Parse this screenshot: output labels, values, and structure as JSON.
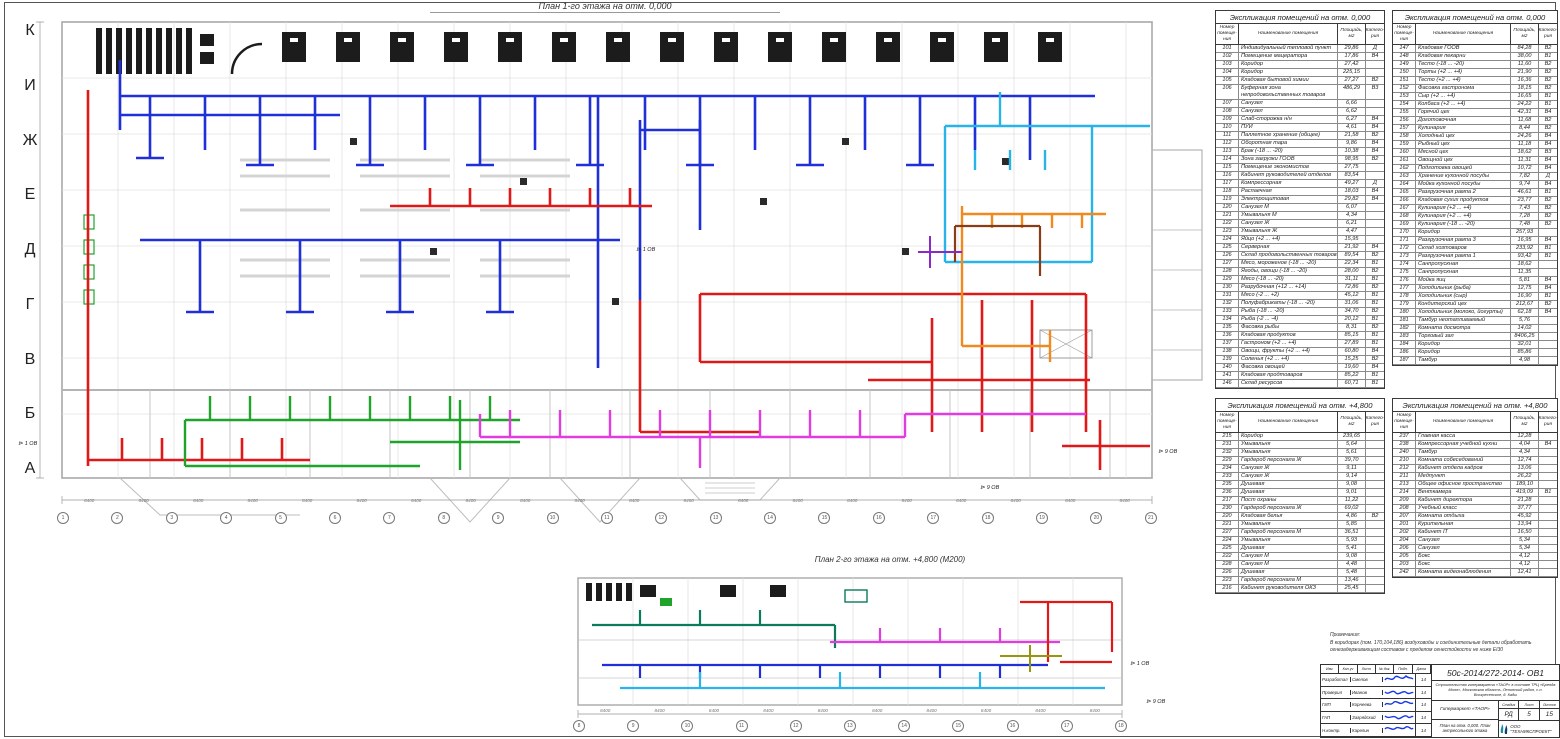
{
  "plan1": {
    "title": "План 1-го этажа на отм. 0,000",
    "axis_bottom": [
      "1",
      "2",
      "3",
      "4",
      "5",
      "6",
      "7",
      "8",
      "9",
      "10",
      "11",
      "12",
      "13",
      "14",
      "15",
      "16",
      "17",
      "18",
      "19",
      "20",
      "21"
    ],
    "axis_left": [
      "К",
      "И",
      "Ж",
      "Е",
      "Д",
      "Г",
      "В",
      "Б",
      "А"
    ],
    "dims_bottom": [
      "8400",
      "8400",
      "8400",
      "8400",
      "8400",
      "8400",
      "8400",
      "8400",
      "8400",
      "8400",
      "8400",
      "8400",
      "8400",
      "8400",
      "8400",
      "8400",
      "8400",
      "8400",
      "8400",
      "8400"
    ]
  },
  "plan2": {
    "title": "План 2-го этажа на отм. +4,800 (М200)",
    "axis_bottom": [
      "8",
      "9",
      "10",
      "11",
      "12",
      "13",
      "14",
      "15",
      "16",
      "17",
      "18"
    ],
    "dims_bottom": [
      "8400",
      "8400",
      "8400",
      "8400",
      "8400",
      "8400",
      "8400",
      "8400",
      "8400",
      "8400"
    ]
  },
  "flags": {
    "labels": [
      "1 ОВ",
      "1 ОВ",
      "9 ОВ",
      "9 ОВ",
      "1 ОВ",
      "9 ОВ"
    ]
  },
  "colors": {
    "duct_supply_blue": "#2030d8",
    "duct_return_red": "#e01818",
    "duct_cyan": "#28b4e8",
    "duct_green": "#1fa32a",
    "duct_magenta": "#e03ce0",
    "duct_orange": "#f08a1e",
    "duct_brown": "#8a3c14",
    "duct_teal": "#0c7a5c",
    "duct_olive": "#96960f",
    "duct_purple": "#8a28c8",
    "equipment_black": "#1c1c1c",
    "walls_gray": "#b0b0b0",
    "signature_blue": "#1538e8"
  },
  "tables": [
    {
      "title": "Экспликация помещений на отм. 0,000",
      "col_num": "Номер помеще- ния",
      "col_name": "Наименование помещения",
      "col_area": "Площадь, м2",
      "col_cat": "Катего- рия",
      "rows": [
        [
          "101",
          "Индивидуальный тепловой пункт",
          "29,86",
          "Д"
        ],
        [
          "102",
          "Помещение мацератора",
          "17,86",
          "В4"
        ],
        [
          "103",
          "Коридор",
          "27,42",
          ""
        ],
        [
          "104",
          "Коридор",
          "225,15",
          ""
        ],
        [
          "105",
          "Кладовая бытовой химии",
          "27,27",
          "В2"
        ],
        [
          "106",
          "Буферная зона непродовольственных товаров",
          "486,29",
          "В3"
        ],
        [
          "107",
          "Санузел",
          "6,66",
          ""
        ],
        [
          "108",
          "Санузел",
          "6,62",
          ""
        ],
        [
          "109",
          "Слаб-сторожка н/н",
          "6,27",
          "В4"
        ],
        [
          "110",
          "ПУИ",
          "4,61",
          "В4"
        ],
        [
          "111",
          "Паллетное хранение (общее)",
          "21,58",
          "В2"
        ],
        [
          "112",
          "Оборотная тара",
          "9,86",
          "В4"
        ],
        [
          "113",
          "Брак (-18 ... -20)",
          "10,38",
          "В4"
        ],
        [
          "114",
          "Зона загрузки ГООВ",
          "98,95",
          "В2"
        ],
        [
          "115",
          "Помещение экономистов",
          "27,75",
          ""
        ],
        [
          "116",
          "Кабинет руководителей отделов",
          "83,54",
          ""
        ],
        [
          "117",
          "Компрессорная",
          "49,27",
          "Д"
        ],
        [
          "118",
          "Распаечная",
          "18,03",
          "В4"
        ],
        [
          "119",
          "Электрощитовая",
          "29,82",
          "В4"
        ],
        [
          "120",
          "Санузел М",
          "6,07",
          ""
        ],
        [
          "121",
          "Умывальня М",
          "4,34",
          ""
        ],
        [
          "122",
          "Санузел Ж",
          "6,21",
          ""
        ],
        [
          "123",
          "Умывальня Ж",
          "4,47",
          ""
        ],
        [
          "124",
          "Яйцо (+2 ... +4)",
          "15,95",
          ""
        ],
        [
          "125",
          "Серверная",
          "21,92",
          "В4"
        ],
        [
          "126",
          "Склад продовольственных товаров",
          "89,54",
          "В2"
        ],
        [
          "127",
          "Мясо, мороженое (-18 ... -20)",
          "22,34",
          "В1"
        ],
        [
          "128",
          "Ягоды, овощи (-18 ... -20)",
          "28,00",
          "В2"
        ],
        [
          "129",
          "Мясо (-18 ... -20)",
          "31,11",
          "В1"
        ],
        [
          "130",
          "Разрубочная (+12 ... +14)",
          "72,86",
          "В2"
        ],
        [
          "131",
          "Мясо (-2 ... +2)",
          "45,12",
          "В1"
        ],
        [
          "132",
          "Полуфабрикаты (-18 ... -20)",
          "31,06",
          "В1"
        ],
        [
          "133",
          "Рыба (-18 ... -20)",
          "34,70",
          "В2"
        ],
        [
          "134",
          "Рыба (-2 ... -4)",
          "20,12",
          "В1"
        ],
        [
          "135",
          "Фасовка рыбы",
          "8,31",
          "В2"
        ],
        [
          "136",
          "Кладовая продуктов",
          "85,15",
          "В1"
        ],
        [
          "137",
          "Гастроном (+2 ... +4)",
          "27,89",
          "В1"
        ],
        [
          "138",
          "Овощи, фрукты (+2 ... +4)",
          "60,80",
          "В4"
        ],
        [
          "139",
          "Соленья (+2 ... +4)",
          "15,25",
          "В2"
        ],
        [
          "140",
          "Фасовка овощей",
          "19,60",
          "В4"
        ],
        [
          "141",
          "Кладовая продтоваров",
          "85,22",
          "В1"
        ],
        [
          "146",
          "Склад ресурсов",
          "60,71",
          "В1"
        ]
      ]
    },
    {
      "title": "Экспликация помещений на отм. 0,000",
      "col_num": "Номер помеще- ния",
      "col_name": "Наименование помещения",
      "col_area": "Площадь, м2",
      "col_cat": "Катего- рия",
      "rows": [
        [
          "147",
          "Кладовая ГООВ",
          "84,28",
          "В2"
        ],
        [
          "148",
          "Кладовая пекарни",
          "38,00",
          "В1"
        ],
        [
          "149",
          "Тесто (-18 ... -20)",
          "11,60",
          "В2"
        ],
        [
          "150",
          "Торты (+2 ... +4)",
          "21,90",
          "В2"
        ],
        [
          "151",
          "Тесто (+2 ... +4)",
          "16,36",
          "В2"
        ],
        [
          "152",
          "Фасовка гастронома",
          "18,15",
          "В2"
        ],
        [
          "153",
          "Сыр (+2 ... +4)",
          "16,65",
          "В1"
        ],
        [
          "154",
          "Колбаса (+2 ... +4)",
          "24,22",
          "В1"
        ],
        [
          "155",
          "Горячий цех",
          "42,31",
          "В4"
        ],
        [
          "156",
          "Доготовочная",
          "11,68",
          "В2"
        ],
        [
          "157",
          "Кулинария",
          "8,44",
          "В2"
        ],
        [
          "158",
          "Холодный цех",
          "24,26",
          "В4"
        ],
        [
          "159",
          "Рыбный цех",
          "11,18",
          "В4"
        ],
        [
          "160",
          "Мясной цех",
          "18,62",
          "В3"
        ],
        [
          "161",
          "Овощной цех",
          "11,31",
          "В4"
        ],
        [
          "162",
          "Подготовка овощей",
          "10,72",
          "В4"
        ],
        [
          "163",
          "Хранение кухонной посуды",
          "7,82",
          "Д"
        ],
        [
          "164",
          "Мойка кухонной посуды",
          "9,74",
          "В4"
        ],
        [
          "165",
          "Разгрузочная рампа 2",
          "46,61",
          "В1"
        ],
        [
          "166",
          "Кладовая сухих продуктов",
          "23,77",
          "В2"
        ],
        [
          "167",
          "Кулинария (+2 ... +4)",
          "7,43",
          "В2"
        ],
        [
          "168",
          "Кулинария (+2 ... +4)",
          "7,28",
          "В2"
        ],
        [
          "169",
          "Кулинария (-18 ... -20)",
          "7,48",
          "В2"
        ],
        [
          "170",
          "Коридор",
          "257,93",
          ""
        ],
        [
          "171",
          "Разгрузочная рампа 3",
          "16,95",
          "В4"
        ],
        [
          "172",
          "Склад хозтоваров",
          "233,92",
          "В1"
        ],
        [
          "173",
          "Разгрузочная рампа 1",
          "93,42",
          "В1"
        ],
        [
          "174",
          "Санпропускная",
          "18,62",
          ""
        ],
        [
          "175",
          "Санпропускная",
          "11,35",
          ""
        ],
        [
          "176",
          "Мойка яиц",
          "5,81",
          "В4"
        ],
        [
          "177",
          "Холодильник (рыба)",
          "12,75",
          "В4"
        ],
        [
          "178",
          "Холодильник (сыр)",
          "16,90",
          "В1"
        ],
        [
          "179",
          "Кондитерский цех",
          "212,67",
          "В2"
        ],
        [
          "180",
          "Холодильник (молоко, йогурты)",
          "62,18",
          "В4"
        ],
        [
          "181",
          "Тамбур неотапливаемый",
          "5,76",
          ""
        ],
        [
          "182",
          "Комната досмотра",
          "14,02",
          ""
        ],
        [
          "183",
          "Торговый зал",
          "8406,25",
          ""
        ],
        [
          "184",
          "Коридор",
          "32,01",
          ""
        ],
        [
          "186",
          "Коридор",
          "85,86",
          ""
        ],
        [
          "187",
          "Тамбур",
          "4,98",
          ""
        ]
      ]
    },
    {
      "title": "Экспликация помещений на отм. +4,800",
      "col_num": "Номер помеще- ния",
      "col_name": "Наименование помещения",
      "col_area": "Площадь, м2",
      "col_cat": "Катего- рия",
      "rows": [
        [
          "215",
          "Коридор",
          "239,65",
          ""
        ],
        [
          "231",
          "Умывальня",
          "5,64",
          ""
        ],
        [
          "232",
          "Умывальня",
          "5,61",
          ""
        ],
        [
          "229",
          "Гардероб персонала Ж",
          "39,70",
          ""
        ],
        [
          "234",
          "Санузел Ж",
          "9,11",
          ""
        ],
        [
          "233",
          "Санузел Ж",
          "9,14",
          ""
        ],
        [
          "235",
          "Душевая",
          "9,08",
          ""
        ],
        [
          "236",
          "Душевая",
          "9,01",
          ""
        ],
        [
          "217",
          "Пост охраны",
          "11,22",
          ""
        ],
        [
          "230",
          "Гардероб персонала Ж",
          "69,02",
          ""
        ],
        [
          "220",
          "Кладовая белья",
          "4,86",
          "В2"
        ],
        [
          "221",
          "Умывальня",
          "5,85",
          ""
        ],
        [
          "227",
          "Гардероб персонала М",
          "36,51",
          ""
        ],
        [
          "224",
          "Умывальня",
          "5,93",
          ""
        ],
        [
          "225",
          "Душевая",
          "5,41",
          ""
        ],
        [
          "222",
          "Санузел М",
          "9,08",
          ""
        ],
        [
          "228",
          "Санузел М",
          "4,48",
          ""
        ],
        [
          "226",
          "Душевая",
          "5,48",
          ""
        ],
        [
          "223",
          "Гардероб персонала М",
          "13,46",
          ""
        ],
        [
          "216",
          "Кабинет руководителя ОКЗ",
          "25,45",
          ""
        ]
      ]
    },
    {
      "title": "Экспликация помещений на отм. +4,800",
      "col_num": "Номер помеще- ния",
      "col_name": "Наименование помещения",
      "col_area": "Площадь, м2",
      "col_cat": "Катего- рия",
      "rows": [
        [
          "237",
          "Главная касса",
          "12,28",
          ""
        ],
        [
          "238",
          "Компрессорная учебной кухни",
          "4,04",
          "В4"
        ],
        [
          "240",
          "Тамбур",
          "4,34",
          ""
        ],
        [
          "210",
          "Комната собеседований",
          "12,74",
          ""
        ],
        [
          "212",
          "Кабинет отдела кадров",
          "13,06",
          ""
        ],
        [
          "211",
          "Медпункт",
          "26,22",
          ""
        ],
        [
          "213",
          "Общее офисное пространство",
          "189,10",
          ""
        ],
        [
          "214",
          "Венткамера",
          "419,09",
          "В1"
        ],
        [
          "209",
          "Кабинет директора",
          "21,28",
          ""
        ],
        [
          "208",
          "Учебный класс",
          "37,77",
          ""
        ],
        [
          "207",
          "Комната отдыха",
          "45,92",
          ""
        ],
        [
          "201",
          "Курительная",
          "13,94",
          ""
        ],
        [
          "202",
          "Кабинет IT",
          "16,50",
          ""
        ],
        [
          "204",
          "Санузел",
          "5,34",
          ""
        ],
        [
          "206",
          "Санузел",
          "5,34",
          ""
        ],
        [
          "205",
          "Бокс",
          "4,12",
          ""
        ],
        [
          "203",
          "Бокс",
          "4,12",
          ""
        ],
        [
          "242",
          "Комната видеонаблюдения",
          "12,41",
          ""
        ]
      ]
    }
  ],
  "notes": {
    "title": "Примечания:",
    "text": "В коридорах (пом. 170,104,186)  воздуховоды и соединительные детали обработать огнезадерживающим составом с пределом огнестойкости не ниже EI30"
  },
  "stamp": {
    "doc_number": "50с-2014/272-2014- ОВ1",
    "project_desc": "Строительство гипермаркета «ТАОР» в составе ТРЦ «Бренда Молл», Московская область, Ленинский район, с.п. Воскресенское, д. Кады",
    "object": "Гипермаркет «ТАОР»",
    "sheet_title": "План на отм. 0,000. План антресольного этажа",
    "company": "ООО \"ТЕХНИКСПРОЕКТ\"",
    "stage_label": "Стадия",
    "sheet_label": "Лист",
    "sheets_label": "Листов",
    "stage": "РД",
    "sheet": "5",
    "sheets": "15",
    "sig_header": [
      "Изм.",
      "Кол.уч",
      "Лист",
      "№ док.",
      "Подп.",
      "Дата"
    ],
    "sig_rows": [
      [
        "Разработал",
        "Смелов",
        "14"
      ],
      [
        "Проверил",
        "Иванов",
        "14"
      ],
      [
        "ГИП",
        "Корнеева",
        "14"
      ],
      [
        "ГАП",
        "Загрядский",
        "14"
      ],
      [
        "Н.контр.",
        "Карелин",
        "14"
      ]
    ]
  }
}
